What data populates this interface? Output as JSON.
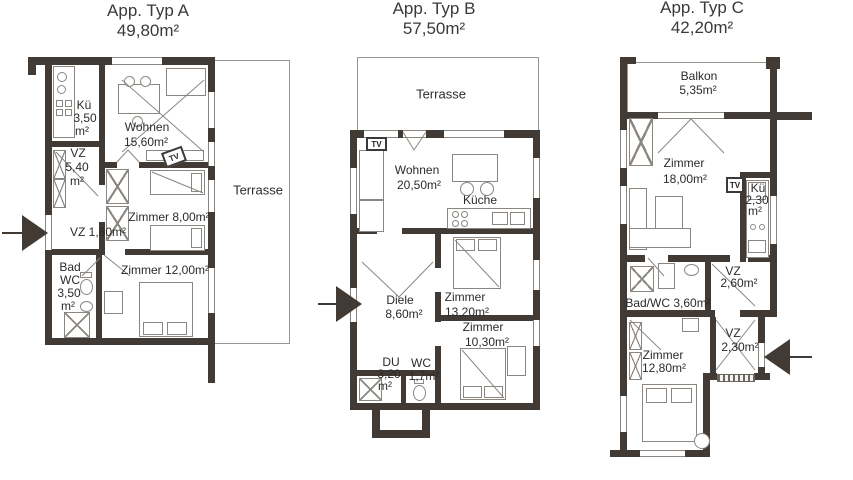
{
  "colors": {
    "wall": "#423a34",
    "furniture_line": "#8b8680",
    "text": "#2b2b2b",
    "background": "#ffffff"
  },
  "plans": [
    {
      "title": "App. Typ A",
      "area": "49,80m²",
      "labels": {
        "terrasse": "Terrasse",
        "tv": "TV",
        "kueche_name": "Kü",
        "kueche_area": "3,50",
        "kueche_unit": "m²",
        "wohnen_name": "Wohnen",
        "wohnen_area": "15,60m²",
        "vz1_name": "VZ",
        "vz1_area": "5,40",
        "vz1_unit": "m²",
        "zimmer1": "Zimmer 8,00m²",
        "vz2": "VZ 1,80m²",
        "bad_line1": "Bad",
        "bad_line2": "WC",
        "bad_line3": "3,50",
        "bad_line4": "m²",
        "zimmer2": "Zimmer 12,00m²"
      }
    },
    {
      "title": "App. Typ B",
      "area": "57,50m²",
      "labels": {
        "terrasse": "Terrasse",
        "tv": "TV",
        "wohnen_name": "Wohnen",
        "wohnen_area": "20,50m²",
        "kueche": "Küche",
        "diele_name": "Diele",
        "diele_area": "8,60m²",
        "zimmer1_name": "Zimmer",
        "zimmer1_area": "13,20m²",
        "zimmer2_name": "Zimmer",
        "zimmer2_area": "10,30m²",
        "du_name": "DU",
        "du_area": "3,20",
        "du_unit": "m²",
        "wc_name": "WC",
        "wc_area": "1,7m²"
      }
    },
    {
      "title": "App. Typ C",
      "area": "42,20m²",
      "labels": {
        "balkon_name": "Balkon",
        "balkon_area": "5,35m²",
        "tv": "TV",
        "zimmer1_name": "Zimmer",
        "zimmer1_area": "18,00m²",
        "kueche_name": "Kü",
        "kueche_area": "2,30",
        "kueche_unit": "m²",
        "vz1_name": "VZ",
        "vz1_area": "2,60m²",
        "bad": "Bad/WC 3,60m²",
        "vz2_name": "VZ",
        "vz2_area": "2,30m²",
        "zimmer2_name": "Zimmer",
        "zimmer2_area": "12,80m²"
      }
    }
  ]
}
